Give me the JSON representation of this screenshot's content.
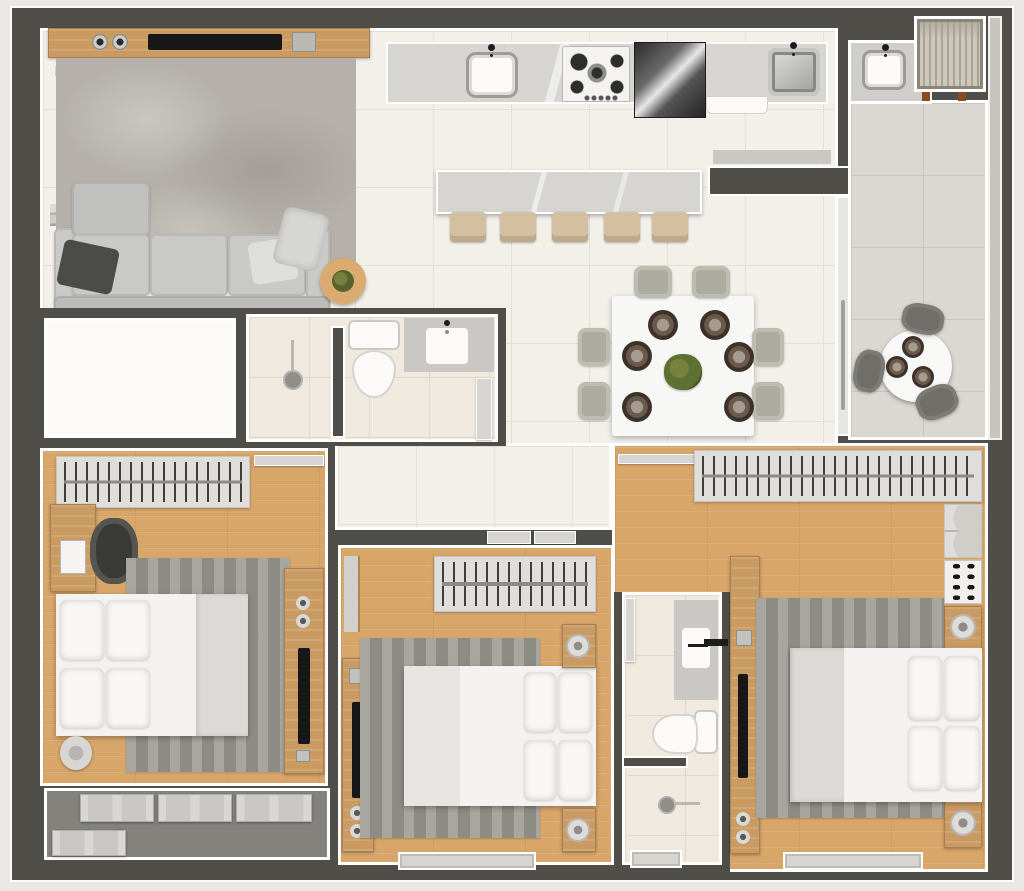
{
  "meta": {
    "type": "floor-plan",
    "description": "Top-down 3D rendered apartment floor plan with no text labels",
    "canvas": {
      "width": 1024,
      "height": 891
    }
  },
  "palette": {
    "background": "#e9e8e4",
    "wall": "#4f4e49",
    "wall_outline": "#ffffff",
    "tile_floor": "#f3f0ea",
    "bath_floor": "#efe9df",
    "balcony_floor": "#dbd8d1",
    "wood_floor": "#d9a66a",
    "wood_furniture": "#c99a62",
    "rug_gray": "#98978f",
    "linen_white": "#f3f2f0",
    "stainless": "#9a9a98",
    "plant_green": "#5f7033"
  },
  "rooms": {
    "living_room": {
      "label": "Living room",
      "furniture": [
        "wood TV console",
        "flat TV",
        "2 speakers",
        "media box",
        "wall shelf",
        "shag rug",
        "3-seat sofa with chaise",
        "dark pillow",
        "light pillow",
        "throw blanket",
        "round side table with plant"
      ]
    },
    "kitchen": {
      "label": "Kitchen",
      "furniture": [
        "marble countertop",
        "white sink with faucet",
        "5-burner gas cooktop",
        "stainless refrigerator",
        "dishwasher front",
        "stainless sink",
        "marble island",
        "5 bar stools"
      ],
      "stool_count": 5
    },
    "dining_area": {
      "label": "Dining area",
      "furniture": [
        "square white table",
        "6 chairs",
        "6 place settings",
        "green centerpiece"
      ],
      "chair_count": 6,
      "place_setting_count": 6
    },
    "hallway": {
      "label": "Hallway",
      "furniture": []
    },
    "storage_room": {
      "label": "Empty room",
      "furniture": []
    },
    "bathroom_social": {
      "label": "Social bathroom",
      "furniture": [
        "shower with head",
        "half wall",
        "toilet",
        "vanity with sink",
        "open door"
      ]
    },
    "bedroom_1": {
      "label": "Bedroom 1",
      "furniture": [
        "open wardrobe with hangers",
        "open door leaf",
        "desk with laptop",
        "office chair",
        "striped rug",
        "double bed with 4 pillows",
        "folded blanket",
        "drum side table",
        "wood TV panel with TV",
        "light switch"
      ]
    },
    "service_balcony": {
      "label": "Service balcony",
      "furniture": [
        "4 AC condenser units"
      ],
      "ac_unit_count": 4
    },
    "bedroom_2": {
      "label": "Bedroom 2",
      "furniture": [
        "sliding entry doors",
        "open wardrobe with hangers",
        "wall shelf",
        "wood TV panel with TV",
        "striped rug",
        "double bed with 4 pillows",
        "2 nightstands with lamps",
        "window"
      ]
    },
    "bathroom_ensuite": {
      "label": "Bathroom 2",
      "furniture": [
        "vanity with sink",
        "open door",
        "toilet",
        "half wall",
        "shower with head",
        "window"
      ]
    },
    "master_bedroom": {
      "label": "Master bedroom",
      "furniture": [
        "open door leaf",
        "long open wardrobe with hangers",
        "drawer unit",
        "shoe shelf with 8 shoes",
        "2 nightstands with lamps",
        "wood TV panel with TV",
        "striped rug",
        "double bed with 4 pillows",
        "folded blanket",
        "window"
      ],
      "shoe_count": 8
    },
    "balcony": {
      "label": "Balcony / terrace",
      "furniture": [
        "sliding glass door with handle",
        "round bistro table",
        "3 chairs",
        "3 place settings",
        "glass rail"
      ],
      "chair_count": 3
    },
    "laundry_nook": {
      "label": "Laundry nook",
      "furniture": [
        "utility tub sink with faucet"
      ]
    },
    "ac_niche": {
      "label": "Louvered AC niche",
      "furniture": [
        "louvered condenser unit",
        "2 feet"
      ]
    }
  }
}
